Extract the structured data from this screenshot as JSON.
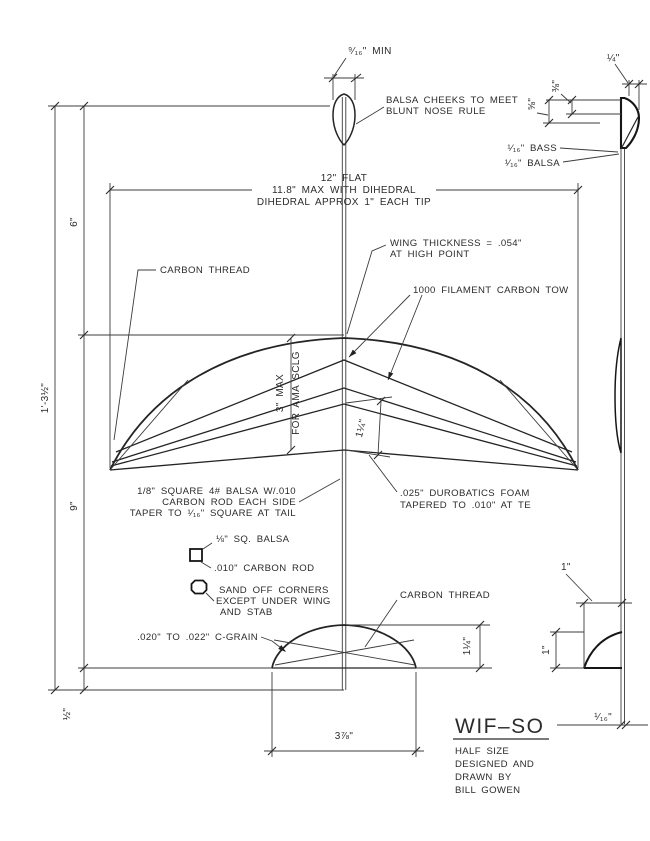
{
  "colors": {
    "ink": "#2b2b2b",
    "paper": "#ffffff"
  },
  "plan": {
    "nose_min": "⁹⁄₁₆\" MIN",
    "balsa_cheeks": [
      "BALSA CHEEKS TO MEET",
      "BLUNT NOSE RULE"
    ],
    "span": [
      "12\" FLAT",
      "11.8\" MAX WITH DIHEDRAL",
      "DIHEDRAL APPROX 1\" EACH TIP"
    ],
    "carbon_thread": "CARBON THREAD",
    "wing_thickness": [
      "WING THICKNESS = .054\"",
      "AT HIGH POINT"
    ],
    "carbon_tow": "1000 FILAMENT CARBON TOW",
    "chord_limit": [
      "3\" MAX",
      "FOR AMA SCLG"
    ],
    "te_strip": "1¼\"",
    "boom_note": [
      "1/8\" SQUARE 4# BALSA W/.010",
      "CARBON ROD EACH SIDE",
      "TAPER TO ¹⁄₁₆\" SQUARE AT TAIL"
    ],
    "foam_note": [
      ".025\" DUROBATICS FOAM",
      "TAPERED TO .010\" AT TE"
    ],
    "sq_balsa": "⅛\" SQ. BALSA",
    "carbon_rod": ".010\" CARBON ROD",
    "sand_note": [
      "SAND OFF CORNERS",
      "EXCEPT UNDER WING",
      "AND STAB"
    ],
    "stab_material": ".020\" TO .022\" C-GRAIN",
    "stab_thread": "CARBON THREAD",
    "stab_chord": "1¼\"",
    "stab_span": "3⅞\""
  },
  "dims_left": {
    "nose_to_le": "6\"",
    "overall": "1'-3½\"",
    "le_to_tail": "9\"",
    "tail_tip": "½\""
  },
  "side": {
    "nose_width": "¼\"",
    "nose_38": "⅜\"",
    "nose_58": "⅝\"",
    "bass": "¹⁄₁₆\" BASS",
    "balsa": "¹⁄₁₆\" BALSA",
    "stab_side_chord": "1\"",
    "stab_side_height": "1\"",
    "boom": "¹⁄₁₆\""
  },
  "title_block": {
    "title": "WIF–SO",
    "lines": [
      "HALF SIZE",
      "DESIGNED AND",
      "DRAWN BY",
      "BILL GOWEN"
    ]
  }
}
